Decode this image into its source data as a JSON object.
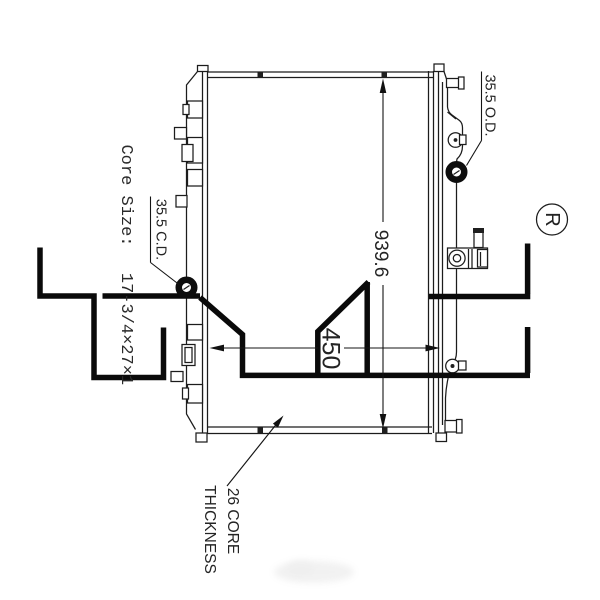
{
  "drawing": {
    "labels": {
      "core_size_label": "Core Size:",
      "core_size_value": "17-3/4×27×1",
      "left_port": "35.5 C.D.",
      "right_port": "35.5 O.D.",
      "core_thickness_line1": "26 CORE",
      "core_thickness_line2": "THICKNESS",
      "registered_symbol": "R"
    },
    "dimensions": {
      "overall_length": "939.6",
      "core_width": "450"
    },
    "colors": {
      "line": "#1c1c1c",
      "thick_line": "#0a0a0a",
      "background": "#ffffff"
    }
  }
}
